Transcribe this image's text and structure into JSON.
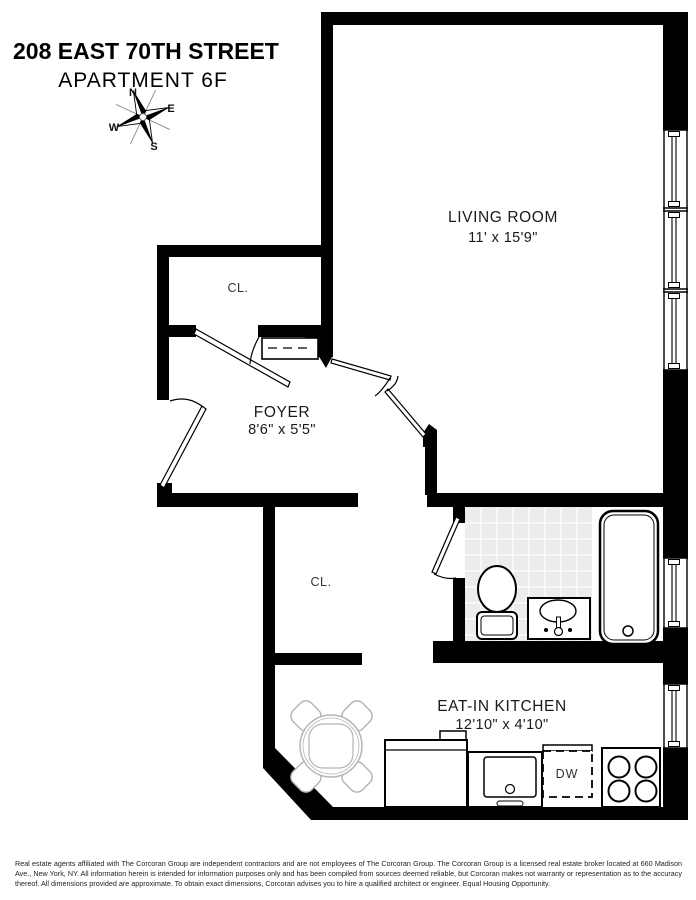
{
  "header": {
    "title": "208 EAST 70TH STREET",
    "subtitle": "APARTMENT 6F"
  },
  "compass": {
    "n": "N",
    "e": "E",
    "s": "S",
    "w": "W"
  },
  "rooms": {
    "living_room": {
      "name": "LIVING ROOM",
      "dims": "11' x 15'9\""
    },
    "foyer": {
      "name": "FOYER",
      "dims": "8'6\" x 5'5\""
    },
    "kitchen": {
      "name": "EAT-IN KITCHEN",
      "dims": "12'10\" x 4'10\""
    },
    "closet_upper": {
      "name": "CL."
    },
    "closet_lower": {
      "name": "CL."
    },
    "dishwasher": {
      "label": "DW"
    }
  },
  "colors": {
    "wall": "#000000",
    "tile": "#ececec",
    "furniture_gray": "#b5b5b5"
  },
  "disclaimer": "Real estate agents affiliated with The Corcoran Group are independent contractors and are not employees of The Corcoran Group. The Corcoran Group is a licensed real estate broker located at 660 Madison Ave., New York, NY. All information herein is intended for information purposes only and has been compiled from sources deemed reliable, but Corcoran makes not warranty or representation as to the accuracy thereof. All dimensions provided are approximate. To obtain exact dimensions, Corcoran advises you to hire a qualified architect or engineer. Equal Housing Opportunity."
}
